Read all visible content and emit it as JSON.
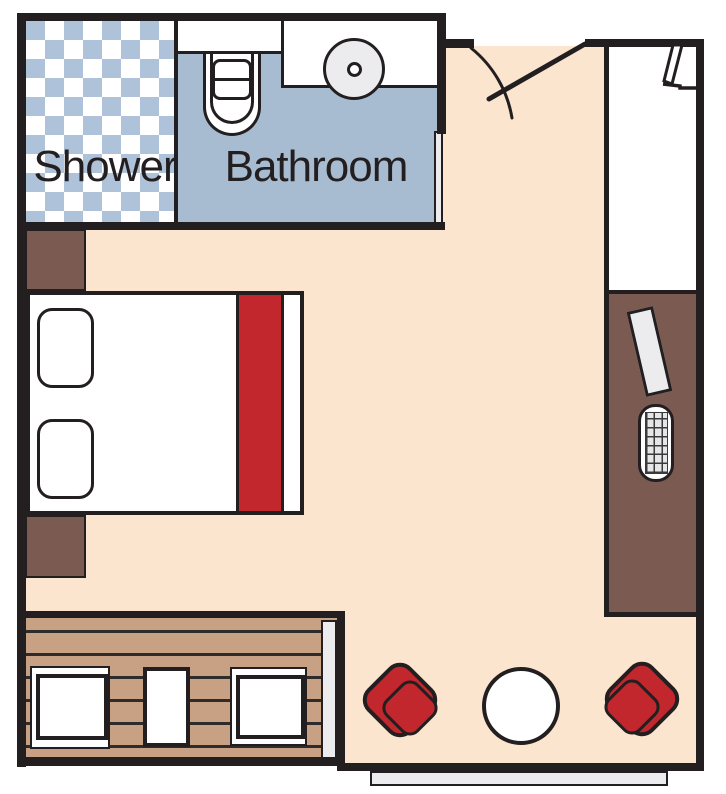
{
  "plan": {
    "title": "Stateroom floor plan",
    "labels": {
      "shower": "Shower",
      "bathroom": "Bathroom"
    },
    "colors": {
      "wall": "#231f20",
      "floor": "#fce5cf",
      "bathfloor": "#a8bcd1",
      "tile": "#aec3d9",
      "wood": "#7b5a52",
      "deck": "#c8a083",
      "red": "#c1272d",
      "gray": "#ececee",
      "plank": "#2e2b2a"
    },
    "features": [
      "shower",
      "bathroom",
      "toilet",
      "sink",
      "bathroom-door",
      "entry-door-swing",
      "corridor",
      "closet-door",
      "wardrobe",
      "ironing-board",
      "luggage-rack",
      "double-bed",
      "pillows",
      "bed-runner",
      "nightstands",
      "veranda-deck",
      "deck-chairs",
      "veranda-table",
      "sliding-glass-door",
      "armchairs",
      "round-side-table",
      "exterior-window"
    ]
  }
}
